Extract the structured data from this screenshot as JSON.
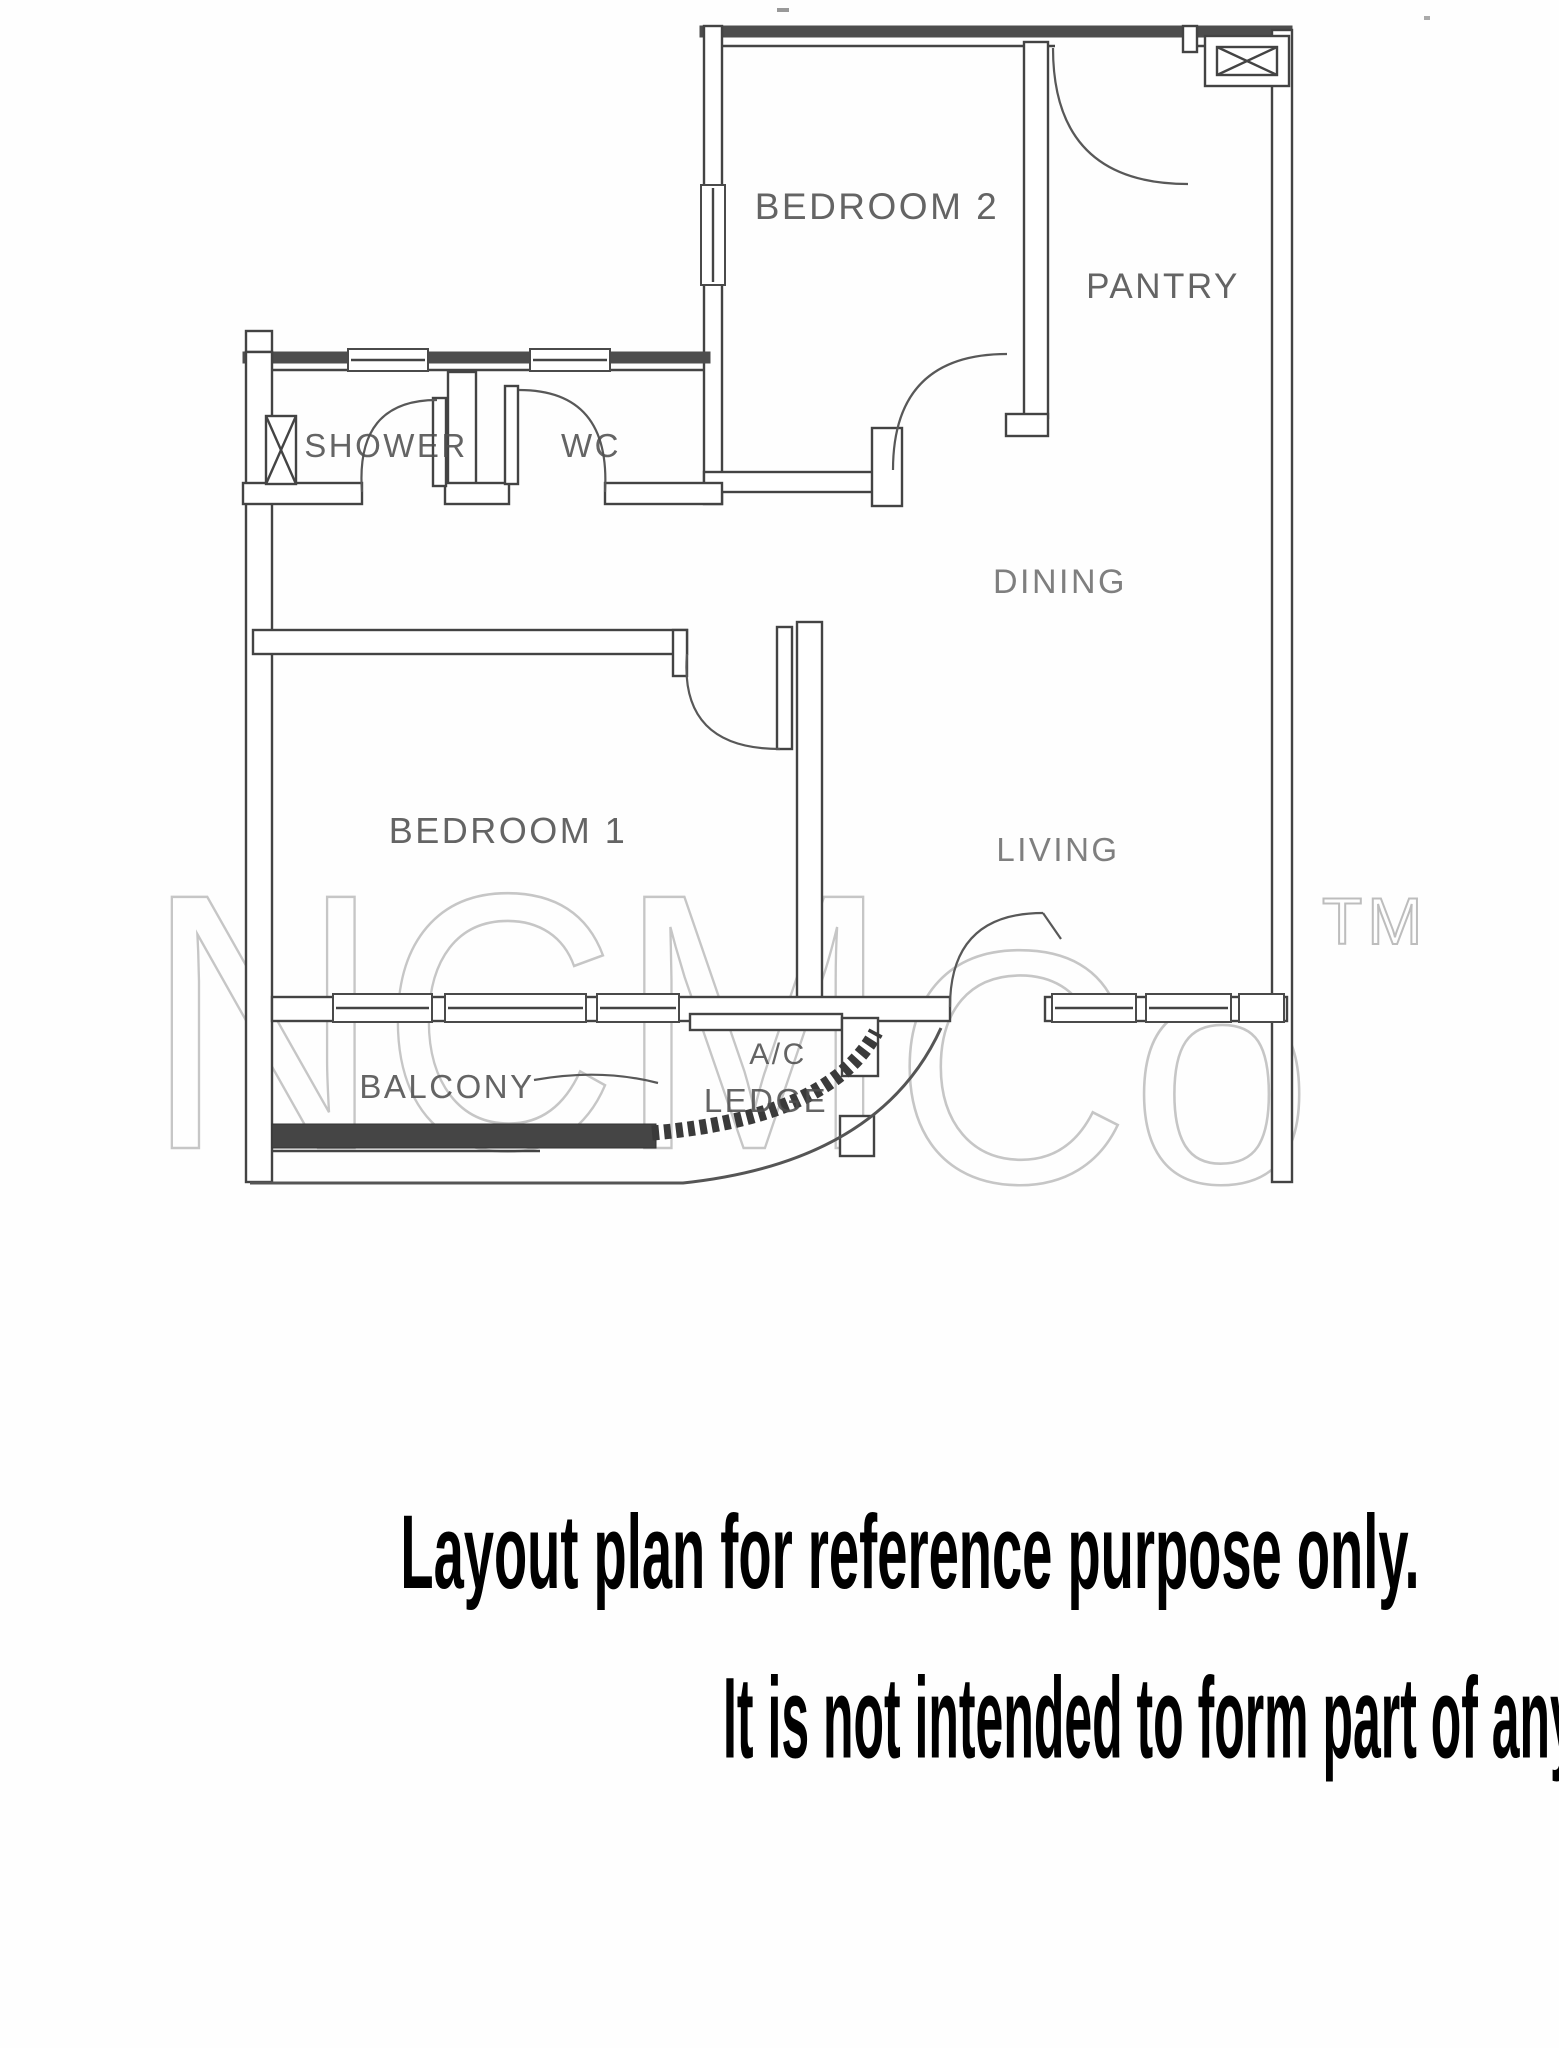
{
  "floor_plan": {
    "room_labels": {
      "bedroom2": "BEDROOM 2",
      "pantry": "PANTRY",
      "shower": "SHOWER",
      "wc": "WC",
      "dining": "DINING",
      "bedroom1": "BEDROOM 1",
      "living": "LIVING",
      "balcony": "BALCONY",
      "ac_ledge_line1": "A/C",
      "ac_ledge_line2": "LEDGE"
    }
  },
  "watermark": {
    "part1": "NCM",
    "part2": "Co",
    "tm": "TM"
  },
  "captions": {
    "line1": "Layout plan for reference purpose only.",
    "line2": "It is not intended to form part of any contract or warranty."
  },
  "colors": {
    "wall_line": "#434343",
    "wall_dark": "#4d4d4d",
    "room_label": "#4f4f4f",
    "watermark": "#c6c6c6",
    "caption_text": "#000000",
    "background": "#ffffff"
  }
}
